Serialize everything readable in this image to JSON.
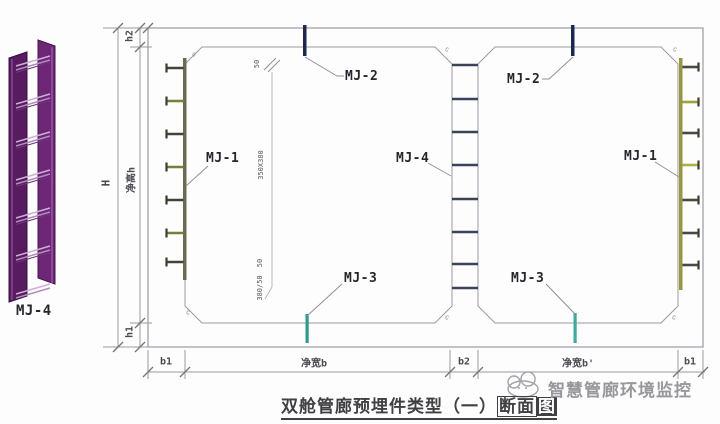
{
  "component": {
    "label": "MJ-4"
  },
  "callouts": {
    "mj2_left": "MJ-2",
    "mj2_right": "MJ-2",
    "mj1_left": "MJ-1",
    "mj1_right": "MJ-1",
    "mj4_center": "MJ-4",
    "mj3_left": "MJ-3",
    "mj3_right": "MJ-3"
  },
  "dimensions": {
    "overall_height": "H",
    "roof_thickness": "h2",
    "clear_height": "净高h",
    "floor_thickness": "h1",
    "left_wall": "b1",
    "left_clear_width": "净宽b",
    "center_wall": "b2",
    "right_clear_width": "净宽b'",
    "right_wall": "b1"
  },
  "annotations": {
    "top_offset": "50",
    "opening_size": "350X380",
    "bottom_offset": "50",
    "bottom_spacing": "380/50",
    "chamfer_mark": "c"
  },
  "title": {
    "full": "双舱管廊预埋件类型（一）断面图",
    "prefix": "双舱管廊预埋件类型（一）",
    "boxed": "断面",
    "inverted": "图"
  },
  "watermark": {
    "text": "智慧管廊环境监控"
  },
  "colors": {
    "purple": "#5f1f68",
    "navy": "#1e2750",
    "teal": "#35a092",
    "olive_plate": "#6b6b50",
    "yellow_green_plate": "#97973f"
  }
}
